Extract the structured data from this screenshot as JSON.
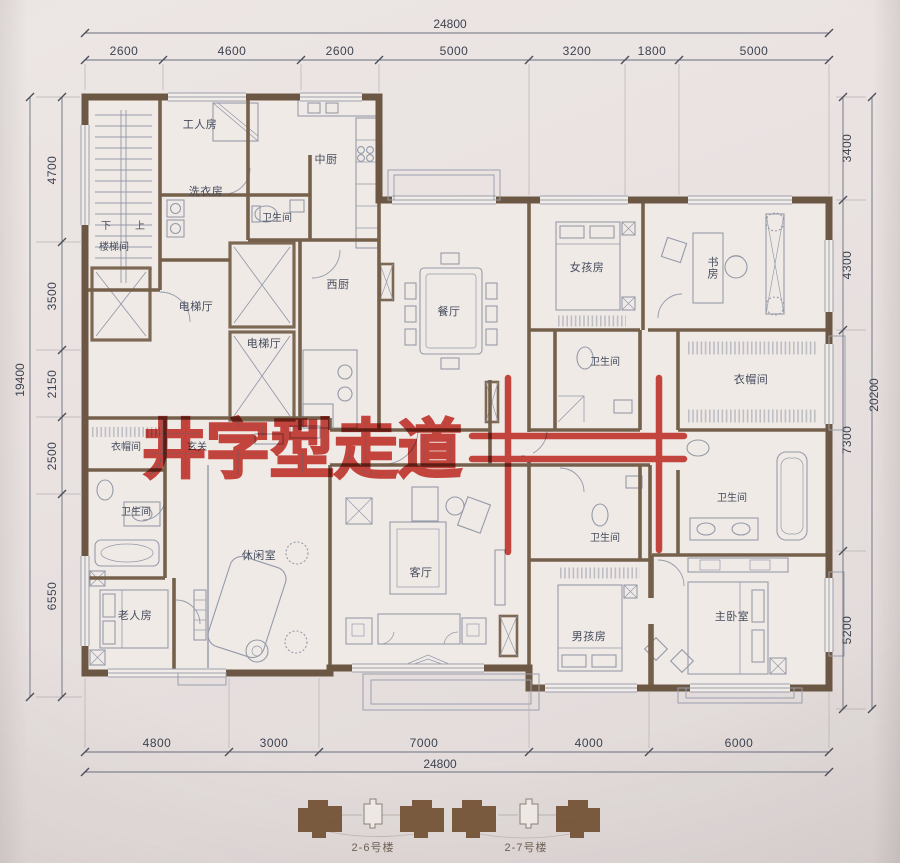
{
  "annotation": {
    "text": "井字型走道",
    "color": "#c5271e"
  },
  "dims": {
    "top_total": "24800",
    "top": [
      "2600",
      "4600",
      "2600",
      "5000",
      "3200",
      "1800",
      "5000"
    ],
    "bottom": [
      "4800",
      "3000",
      "7000",
      "4000",
      "6000"
    ],
    "bottom_total": "24800",
    "left": [
      "4700",
      "3500",
      "2150",
      "2500",
      "6550"
    ],
    "left_total": "19400",
    "right": [
      "3400",
      "4300",
      "7300",
      "5200"
    ],
    "right_total": "20200"
  },
  "rooms": {
    "worker": "工人房",
    "main_kitchen": "中厨",
    "laundry": "洗衣房",
    "bath_top": "卫生间",
    "down": "下",
    "up": "上",
    "stairwell": "楼梯间",
    "west_kitchen": "西厨",
    "dining": "餐厅",
    "girls": "女孩房",
    "study": "书房",
    "elevator_hall_1": "电梯厅",
    "elevator_hall_2": "电梯厅",
    "bath_girls": "卫生间",
    "cloak_right": "衣帽间",
    "cloak_left": "衣帽间",
    "foyer": "玄关",
    "bath_left": "卫生间",
    "leisure": "休闲室",
    "living": "客厅",
    "bath_boys": "卫生间",
    "bath_master": "卫生间",
    "elders": "老人房",
    "boys": "男孩房",
    "master": "主卧室"
  },
  "legend": {
    "building_left": "2-6号楼",
    "building_right": "2-7号楼"
  },
  "colors": {
    "wall": "#6b5743",
    "line": "#8f96a5",
    "red": "#c5271e",
    "paper": "#ece6e4"
  }
}
